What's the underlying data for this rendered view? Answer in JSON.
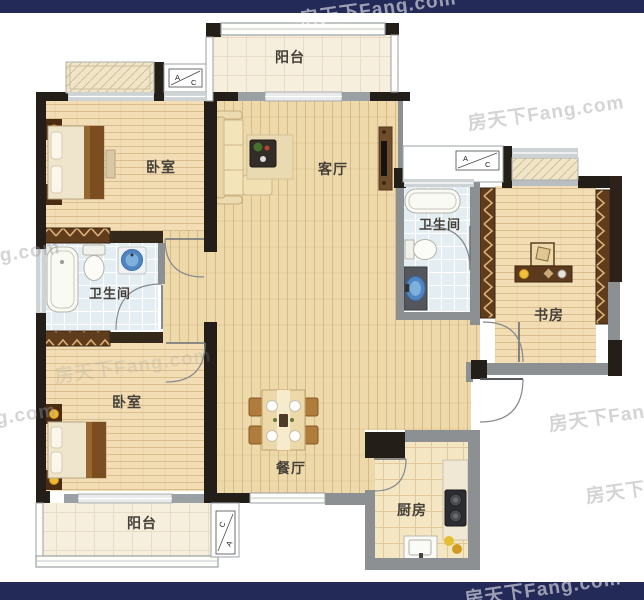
{
  "brand": {
    "watermark": "房天下Fang.com"
  },
  "rooms": {
    "balcony_top": "阳台",
    "bedroom_top": "卧室",
    "living": "客厅",
    "bath_right": "卫生间",
    "study": "书房",
    "bath_left": "卫生间",
    "bedroom_bottom": "卧室",
    "dining": "餐厅",
    "balcony_bottom": "阳台",
    "kitchen": "厨房"
  },
  "ac": {
    "a": "A",
    "c": "C"
  },
  "colors": {
    "top_bar": "#242a58",
    "bottom_bar": "#242a58",
    "wall_dark": "#241e18",
    "wall_gray": "#8d9092",
    "watermark": "#9a9a9a"
  }
}
